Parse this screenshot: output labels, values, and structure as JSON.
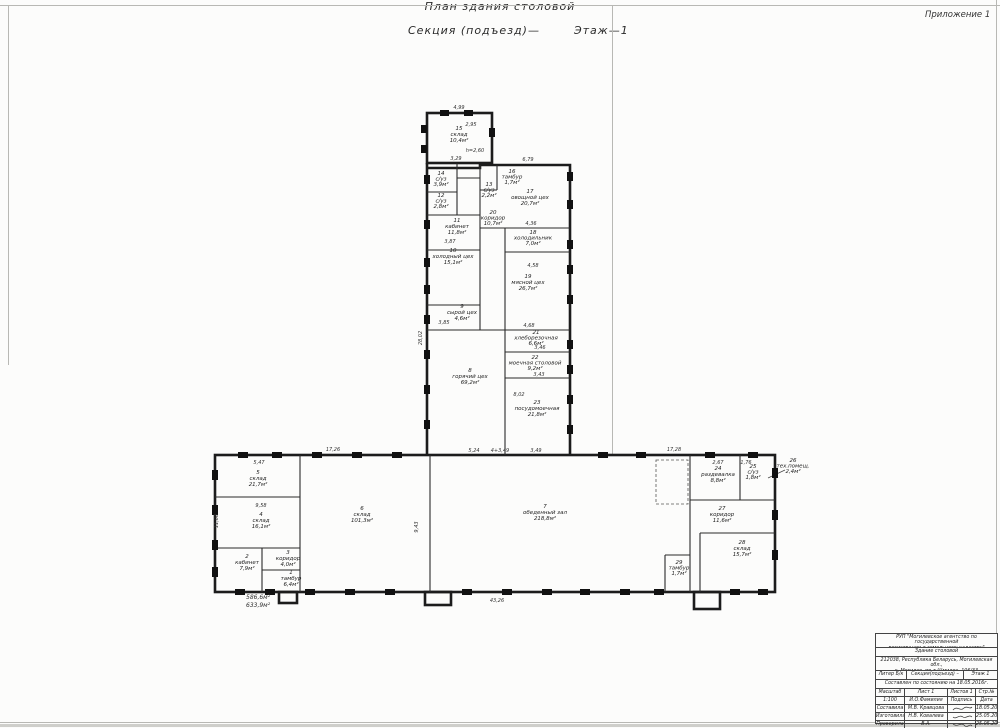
{
  "sheet": {
    "appendix": "Приложение 1",
    "title_line1": "План здания столовой",
    "title_line2_left": "Секция (подъезд)—",
    "title_line2_right": "Этаж—1"
  },
  "plan": {
    "height_note": "h=2,60",
    "area_total_1": "586,6м²",
    "area_total_2": "633,9м²",
    "rooms": [
      {
        "number": "1",
        "name": "тамбур",
        "area": "6,4м²"
      },
      {
        "number": "2",
        "name": "кабинет",
        "area": "7,9м²"
      },
      {
        "number": "3",
        "name": "коридор",
        "area": "4,0м²"
      },
      {
        "number": "4",
        "name": "склад",
        "area": "16,1м²"
      },
      {
        "number": "5",
        "name": "склад",
        "area": "21,7м²"
      },
      {
        "number": "6",
        "name": "склад",
        "area": "101,3м²"
      },
      {
        "number": "7",
        "name": "обеденный зал",
        "area": "218,8м²"
      },
      {
        "number": "8",
        "name": "горячий цех",
        "area": "69,2м²"
      },
      {
        "number": "9",
        "name": "сырой цех",
        "area": "4,6м²"
      },
      {
        "number": "10",
        "name": "холодный цех",
        "area": "15,1м²"
      },
      {
        "number": "11",
        "name": "кабинет",
        "area": "11,8м²"
      },
      {
        "number": "12",
        "name": "с/уз",
        "area": "2,8м²"
      },
      {
        "number": "13",
        "name": "с/уз",
        "area": "2,2м²"
      },
      {
        "number": "14",
        "name": "с/уз",
        "area": "3,9м²"
      },
      {
        "number": "15",
        "name": "склад",
        "area": "10,4м²"
      },
      {
        "number": "16",
        "name": "тамбур",
        "area": "1,7м²"
      },
      {
        "number": "17",
        "name": "овощной цех",
        "area": "20,7м²"
      },
      {
        "number": "18",
        "name": "холодильник",
        "area": "7,0м²"
      },
      {
        "number": "19",
        "name": "мясной цех",
        "area": "26,7м²"
      },
      {
        "number": "20",
        "name": "коридор",
        "area": "10,7м²"
      },
      {
        "number": "21",
        "name": "хлеборезочная",
        "area": "6,6м²"
      },
      {
        "number": "22",
        "name": "моечная столовой",
        "area": "9,2м²"
      },
      {
        "number": "23",
        "name": "посудомоечная",
        "area": "21,8м²"
      },
      {
        "number": "24",
        "name": "раздевалка",
        "area": "8,8м²"
      },
      {
        "number": "25",
        "name": "с/уз",
        "area": "1,8м²"
      },
      {
        "number": "26",
        "name": "тех.помещ.",
        "area": "2,4м²"
      },
      {
        "number": "27",
        "name": "коридор",
        "area": "11,6м²"
      },
      {
        "number": "28",
        "name": "склад",
        "area": "15,7м²"
      },
      {
        "number": "29",
        "name": "тамбур",
        "area": "1,7м²"
      }
    ],
    "dims": [
      "4,99",
      "2,95",
      "3,29",
      "6,79",
      "4,36",
      "4,58",
      "4,68",
      "3,46",
      "3,43",
      "8,02",
      "5,24",
      "4+3,49",
      "3,49",
      "17,26",
      "17,28",
      "43,26",
      "11,08",
      "28,02",
      "9,43",
      "5,47",
      "9,58",
      "2,67",
      "1,76",
      "3,87",
      "3,85"
    ]
  },
  "title_block": {
    "org_line1": "РУП \"Могилевское агентство по государственной",
    "org_line2": "регистрации и земельному кадастру\"",
    "object_name": "Здание столовой",
    "address_line1": "212038, Республика Беларусь, Могилевская обл.,",
    "address_line2": "г. Могилев, пр-т Шмидта, 106/33",
    "liter": "Литер Б/к",
    "section": "Секция(подъезд) –",
    "floor": "Этаж 1",
    "compiled": "Составлен по состоянию на 18.05.2016г.",
    "col1": "Масштаб",
    "col2": "Лист 1",
    "col3": "Листов 1",
    "col4": "Стр.№",
    "scale": "1:100",
    "name_header": "И.О.Фамилия",
    "sig_header": "Подпись",
    "date_header": "Дата",
    "rows": [
      {
        "role": "Составила",
        "name": "М.В. Кравцова",
        "date": "18.05.2016"
      },
      {
        "role": "Изготовила",
        "name": "Н.В. Ковалева",
        "date": "25.05.2016"
      },
      {
        "role": "Проверила",
        "name": "В.А. Новодольская",
        "date": "25.05.2016"
      }
    ]
  }
}
